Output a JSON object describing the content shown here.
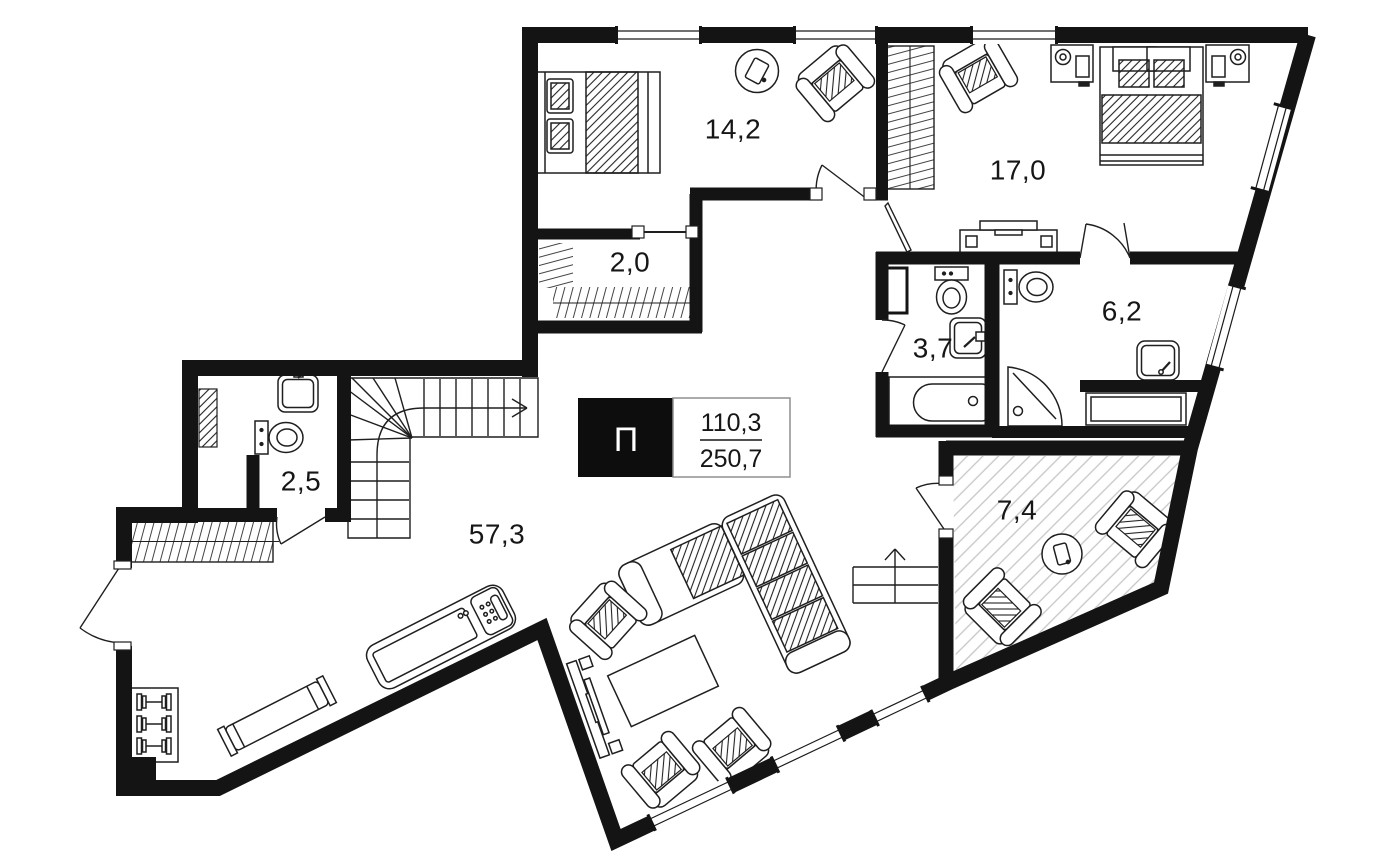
{
  "plan": {
    "unit_type_label": "П",
    "area_values": {
      "upper": "110,3",
      "lower": "250,7"
    },
    "rooms": {
      "bedroom1": {
        "name": "bedroom-top-left",
        "label": "14,2"
      },
      "bedroom2": {
        "name": "bedroom-top-right",
        "label": "17,0"
      },
      "closet": {
        "name": "walk-in-closet",
        "label": "2,0"
      },
      "bathroom1": {
        "name": "bathroom-middle",
        "label": "3,7"
      },
      "bathroom2": {
        "name": "bathroom-ensuite",
        "label": "6,2"
      },
      "bathroom3": {
        "name": "guest-wc",
        "label": "2,5"
      },
      "living": {
        "name": "living-space",
        "label": "57,3"
      },
      "terrace": {
        "name": "terrace",
        "label": "7,4"
      }
    },
    "colors": {
      "wall": "#141414",
      "line": "#1f1f1f",
      "terrace_hatch": "#c6c6c6"
    }
  }
}
